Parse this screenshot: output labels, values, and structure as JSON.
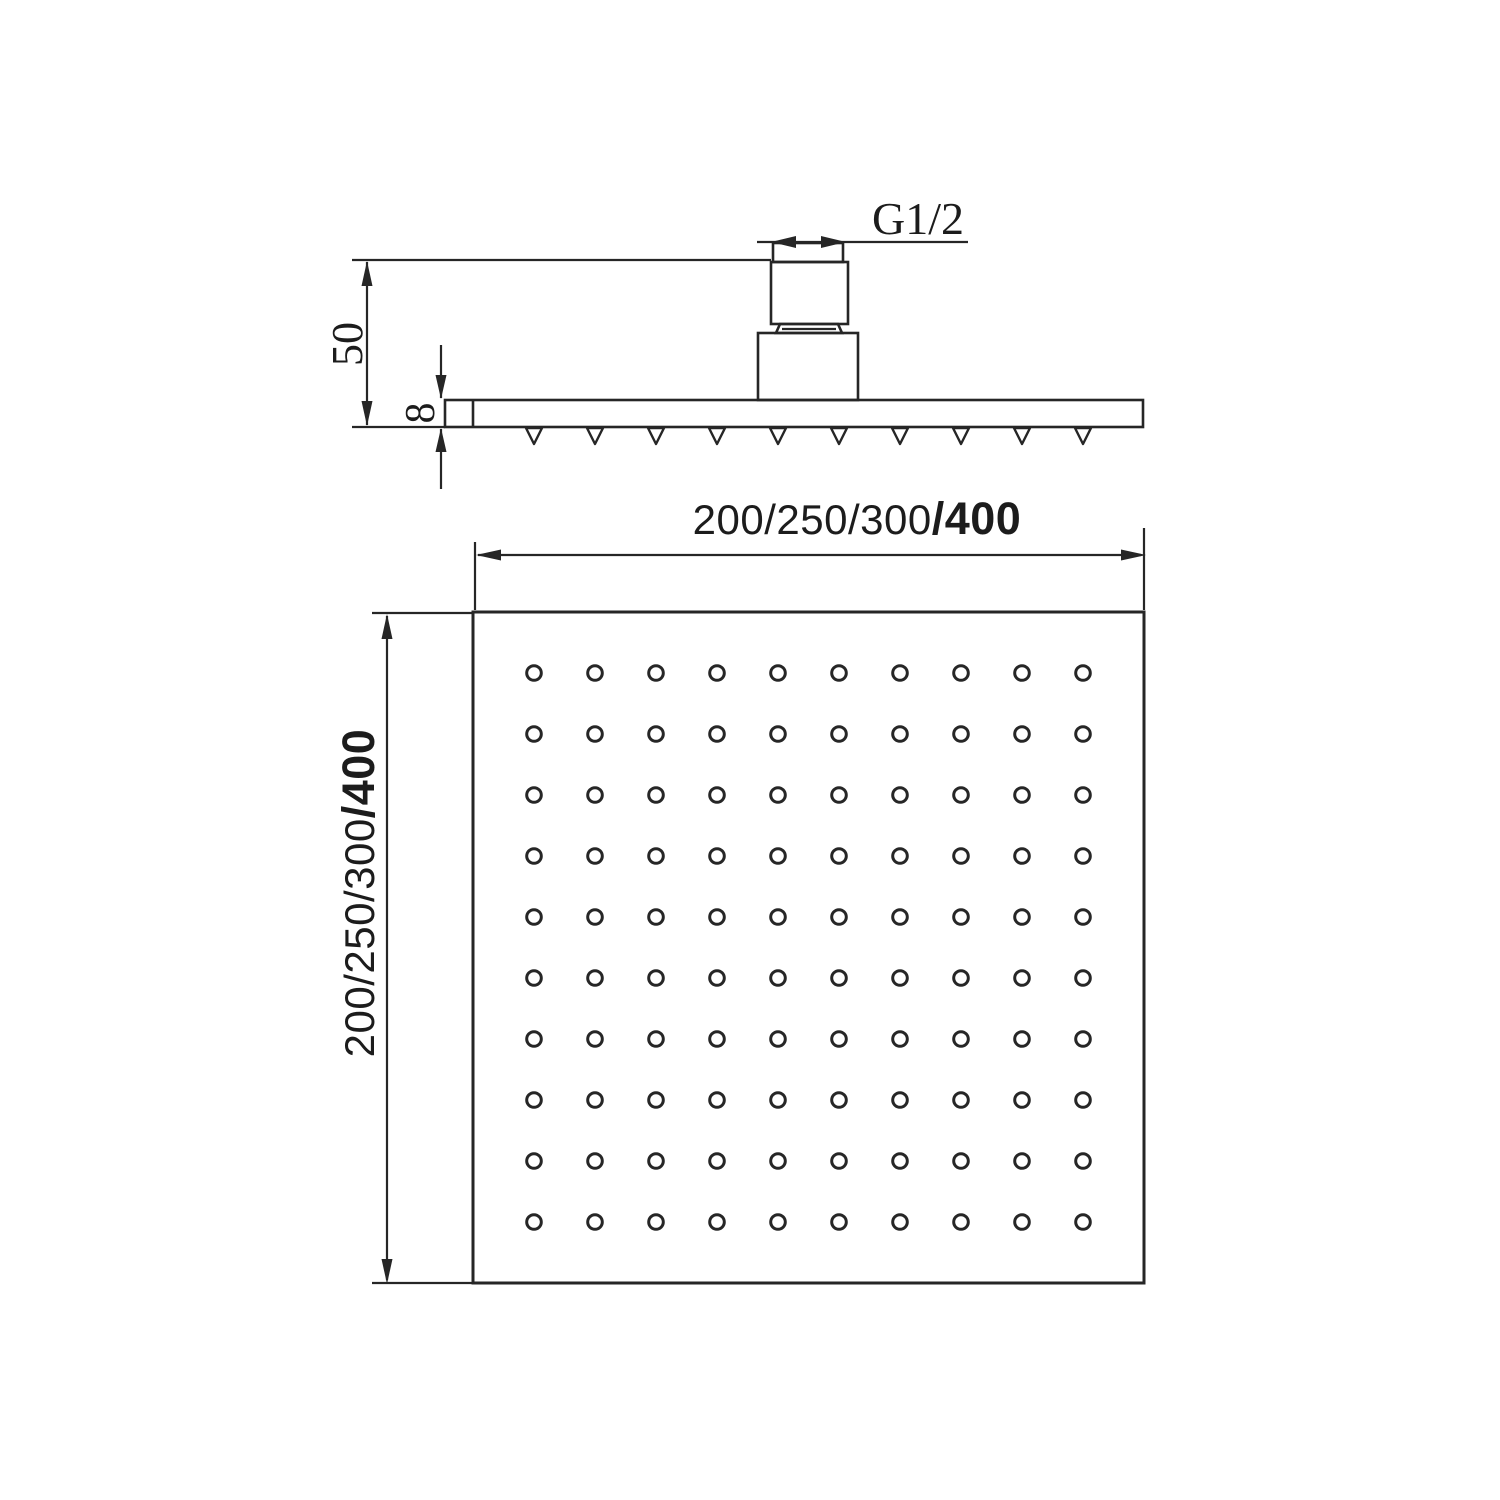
{
  "side_view": {
    "thread_size_label": "G1/2",
    "overall_height_label": "50",
    "plate_thickness_label": "8",
    "nozzle_count": 10
  },
  "plan_view": {
    "width_sizes": "200/250/300",
    "width_selected": "/400",
    "height_sizes": "200/250/300",
    "height_selected": "/400",
    "hole_grid_rows": 10,
    "hole_grid_columns": 10
  },
  "colors": {
    "line": "#262626",
    "background": "#ffffff"
  }
}
